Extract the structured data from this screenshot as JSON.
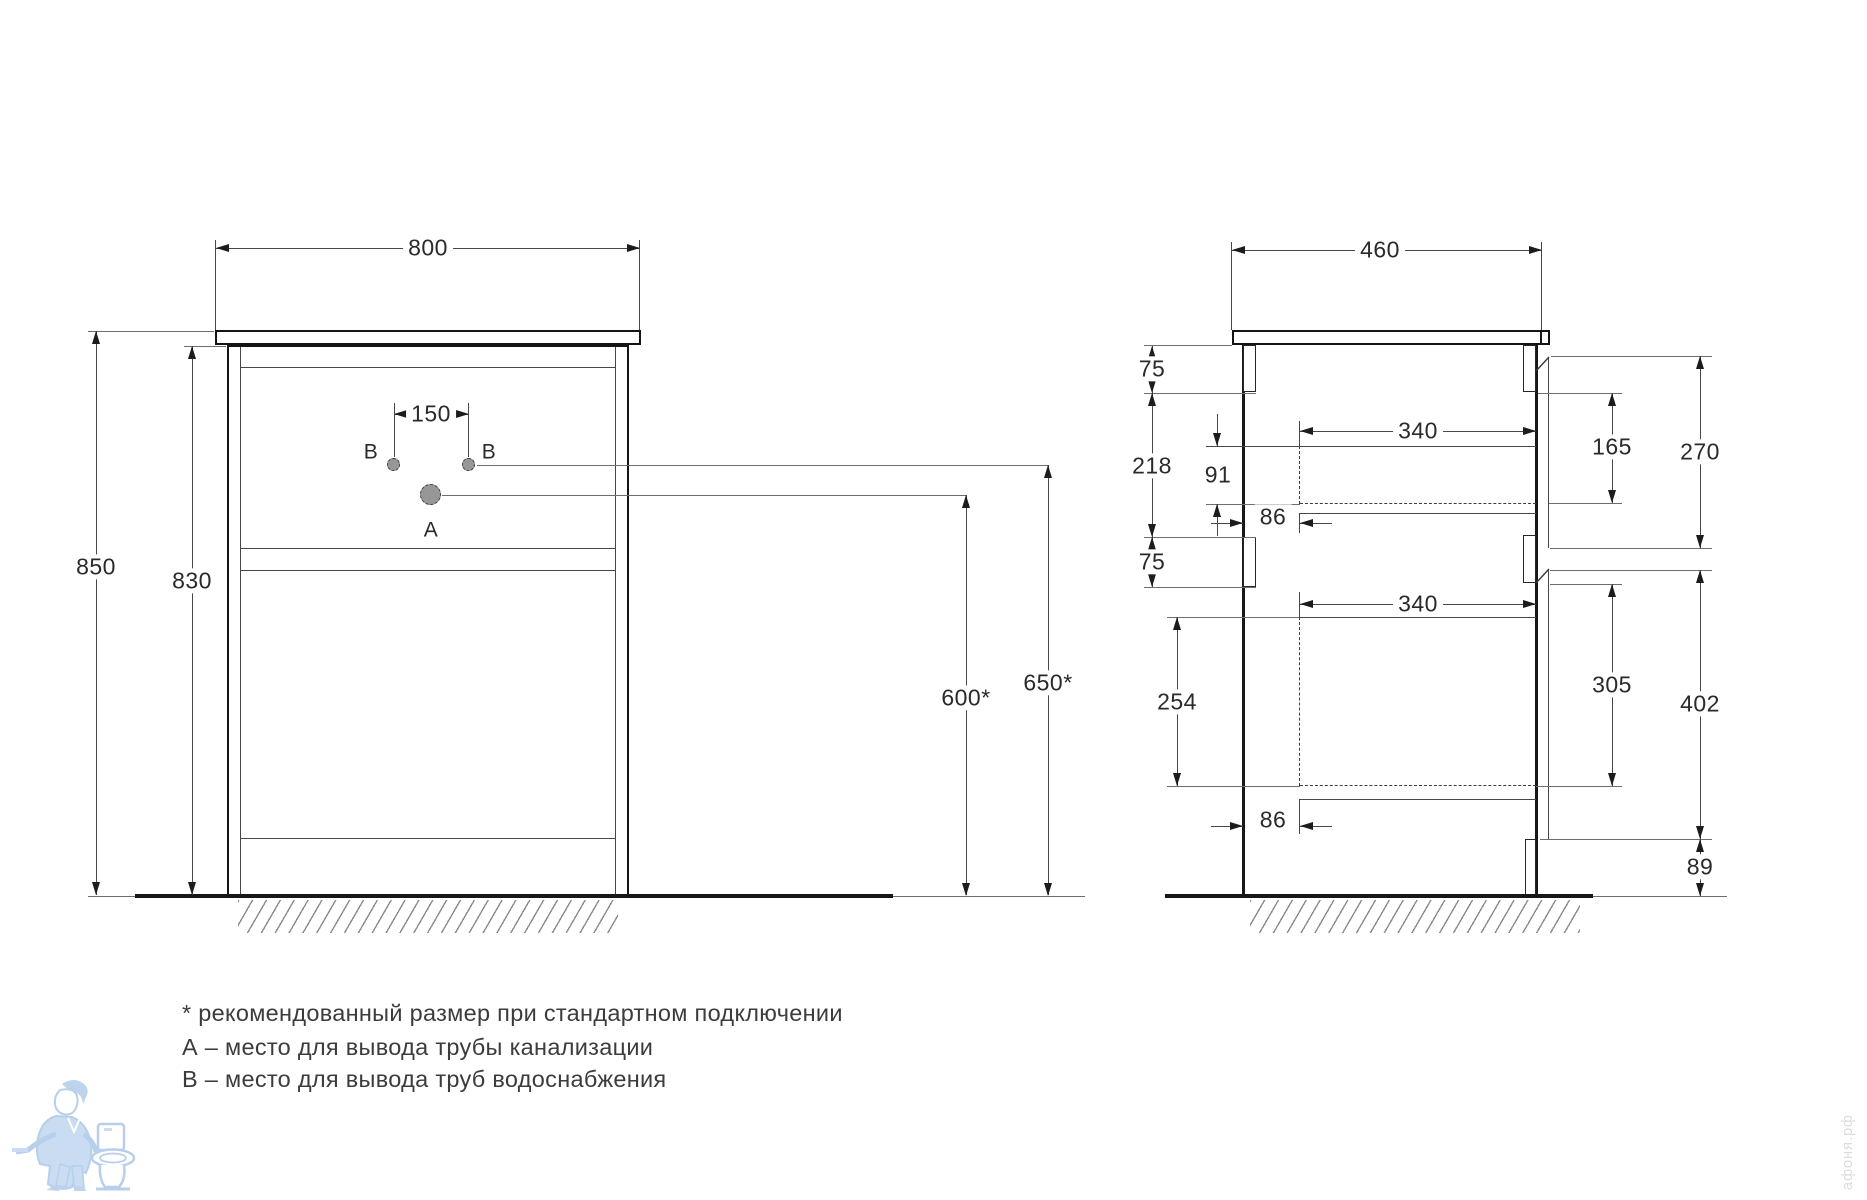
{
  "front_view": {
    "width": "800",
    "total_height": "850",
    "body_height": "830",
    "faucet_holes_spacing": "150",
    "hole_b_left": "В",
    "hole_b_right": "В",
    "hole_a": "А",
    "drain_outlet_height": "600*",
    "water_outlet_height": "650*"
  },
  "side_view": {
    "depth": "460",
    "top_back_rail_height": "75",
    "upper_back_section": "218",
    "drawer1_top_offset": "91",
    "drawer1_back_gap": "86",
    "drawer1_inner_width": "340",
    "drawer1_opening_height": "165",
    "drawer1_front_height": "270",
    "mid_back_rail_height": "75",
    "drawer2_inner_width": "340",
    "drawer2_inner_height": "254",
    "drawer2_opening_height": "305",
    "drawer2_front_height": "402",
    "drawer2_back_gap": "86",
    "plinth_height": "89"
  },
  "legend": {
    "note_recommended": "* рекомендованный размер при стандартном подключении",
    "note_a": "А – место для вывода трубы канализации",
    "note_b": "В – место для вывода труб водоснабжения"
  },
  "watermark": {
    "site": "афоня.рф"
  }
}
